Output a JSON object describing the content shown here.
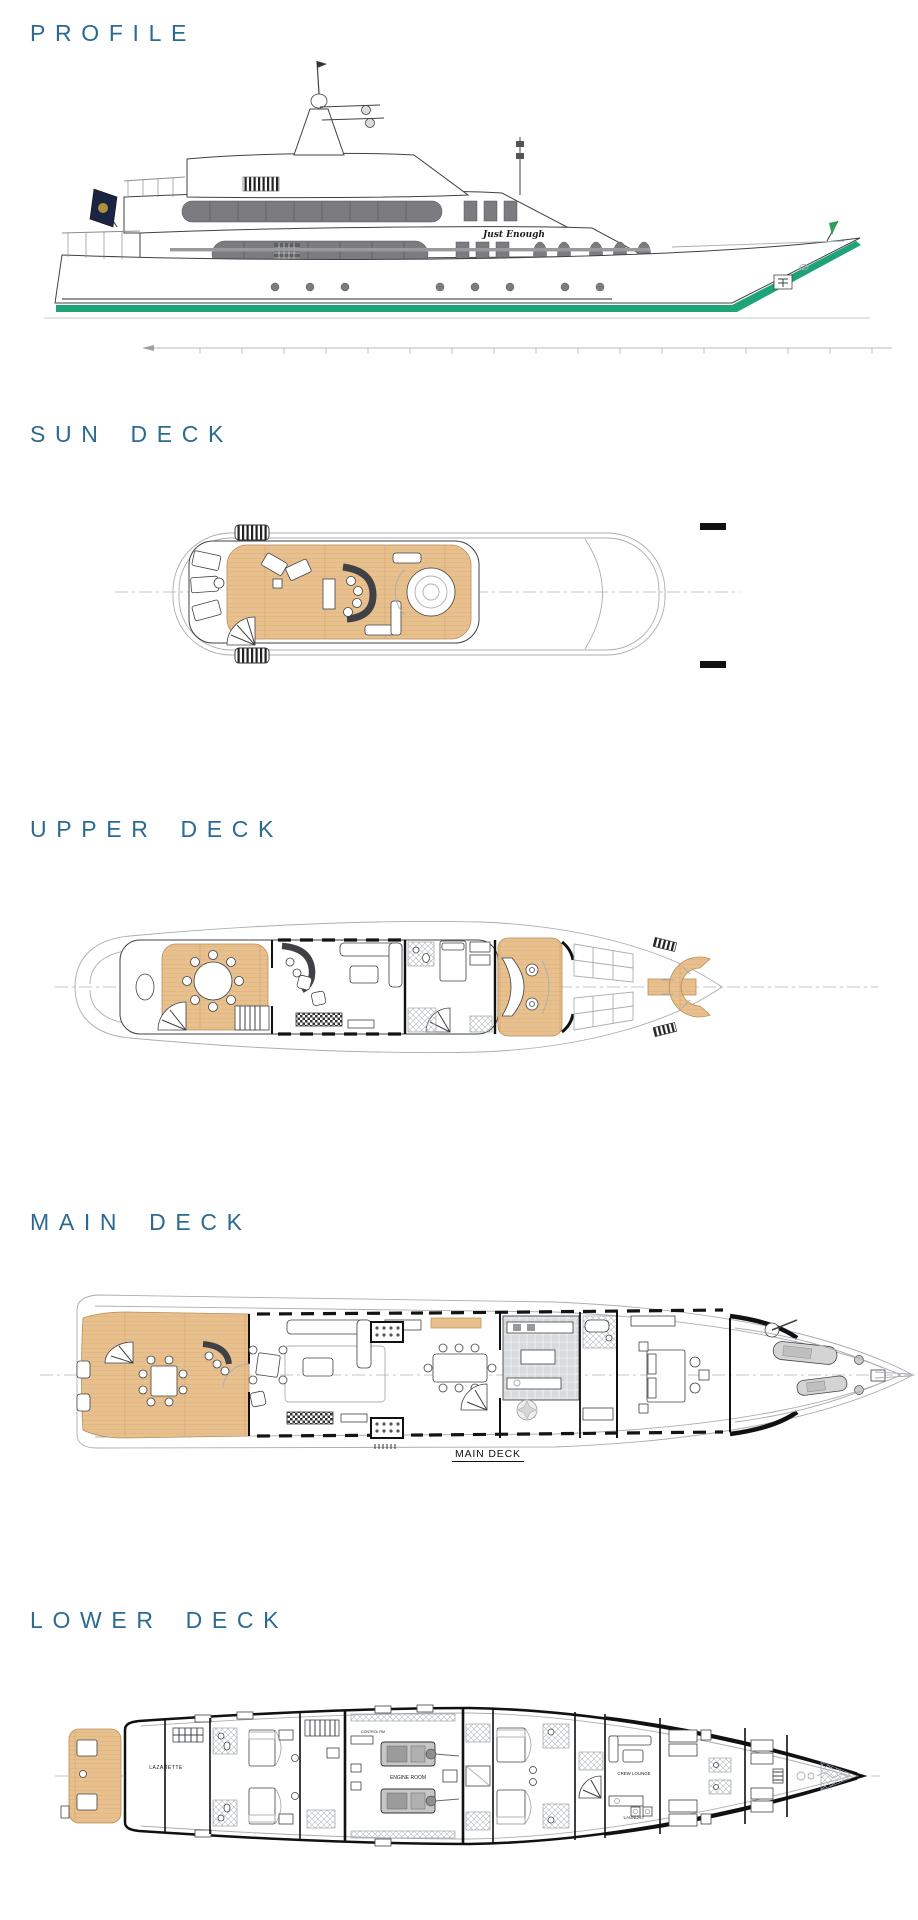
{
  "page": {
    "title": "Yacht general arrangement plans",
    "background": "#ffffff"
  },
  "colors": {
    "heading": "#2b6b93",
    "wood": "#e8c08e",
    "wood_line": "#cf9f69",
    "waterline_green": "#1ea478",
    "window_gray": "#7c7c80",
    "hull_line": "#3f4145",
    "light_line": "#a9adb2",
    "flag_navy": "#1b2442",
    "flag_green": "#2f9e57",
    "tile_gray": "#d8dbde",
    "black": "#111111"
  },
  "sections": [
    {
      "id": "profile",
      "heading": "PROFILE"
    },
    {
      "id": "sun-deck",
      "heading": "SUN DECK"
    },
    {
      "id": "upper-deck",
      "heading": "UPPER DECK"
    },
    {
      "id": "main-deck",
      "heading": "MAIN DECK"
    },
    {
      "id": "lower-deck",
      "heading": "LOWER DECK"
    }
  ],
  "profile": {
    "yacht_name": "Just Enough"
  },
  "main_deck": {
    "plan_label": "MAIN DECK"
  },
  "lower_deck": {
    "labels": {
      "lazarette": "LAZARETTE",
      "control_room": "CONTROL RM",
      "engine_room": "ENGINE ROOM",
      "crew_lounge": "CREW LOUNGE",
      "laundry": "LAUNDRY"
    }
  }
}
